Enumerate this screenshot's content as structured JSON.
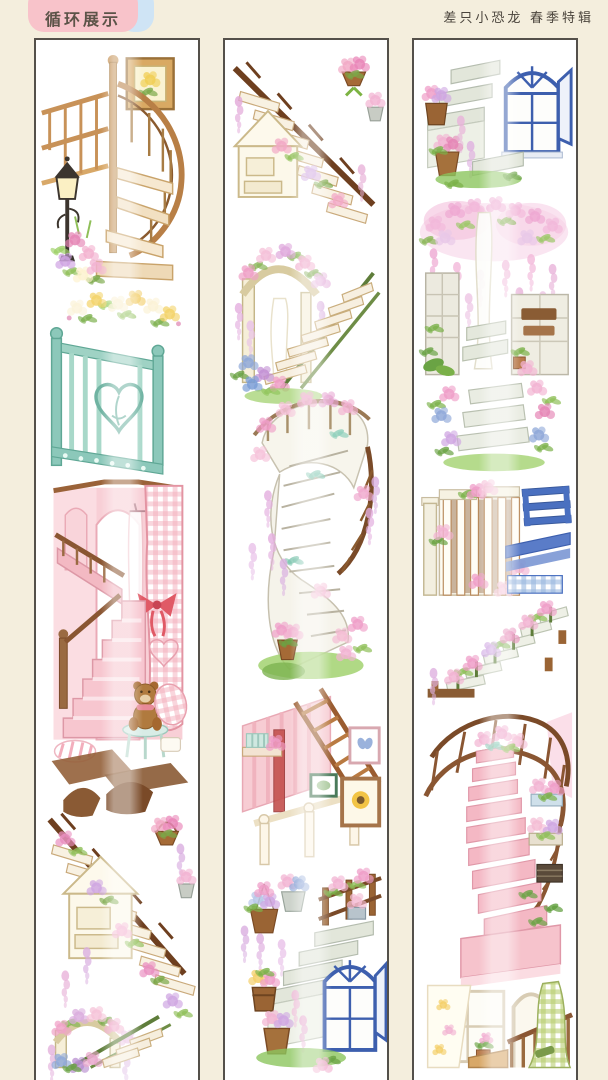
{
  "header": {
    "badge_label": "循环展示",
    "brand_label": "差只小恐龙 春季特辑"
  },
  "colors": {
    "page_background": "#f4eedd",
    "badge_pink": "#f8c3ca",
    "badge_blue": "#cfe4f5",
    "strip_border": "#54504a",
    "strip_background": "#ffffff",
    "text_primary": "#4a443c",
    "accent_wood": "#8a5a34",
    "accent_mint": "#8cc8ba",
    "accent_pink": "#f4b8c4",
    "accent_blue_window": "#3d5fae",
    "accent_green": "#9ccf66",
    "accent_wisteria": "#e3aede"
  },
  "strips": [
    {
      "id": "tape-strip-1",
      "description": "Washi tape strip 1: wooden spiral staircase with street lamp and framed picture; mint iron railing with heart scroll and flower garland; pink interior staircase with gingham curtain and teddy bear; garden staircase with hanging flower baskets; rose arch steps (partial)",
      "vignettes": [
        "wooden-spiral-staircase-with-street-lamp-and-framed-picture",
        "mint-iron-railing-with-heart-scroll-and-flower-garland",
        "pink-interior-staircase-with-gingham-curtain-and-teddy-bear",
        "garden-staircase-with-hanging-flower-baskets",
        "rose-arch-steps-with-green-railing-partial"
      ]
    },
    {
      "id": "tape-strip-2",
      "description": "Washi tape strip 2: garden staircase continued; rose arch steps with green railing; white spiral staircase wrapped in roses and wisteria; pink attic stair with picture frames; stone steps with blue arched window and flower barrels",
      "vignettes": [
        "garden-staircase-with-hanging-flower-baskets-continued",
        "rose-arch-steps-with-green-railing",
        "white-spiral-staircase-wrapped-in-roses-and-wisteria",
        "pink-attic-stair-with-picture-frames",
        "stone-steps-with-blue-arched-window-and-flower-barrels"
      ]
    },
    {
      "id": "tape-strip-3",
      "description": "Washi tape strip 3: stone steps with blue arched window continued; wisteria stone gateway with steps; hydrangea garden steps; white picket gate with blue bench steps; flower lined descending steps; curved pink staircase with iron railing and planters; window with floral curtain and green gingham stair (partial)",
      "vignettes": [
        "stone-steps-with-blue-arched-window-continued",
        "wisteria-stone-gateway-with-steps",
        "hydrangea-garden-steps",
        "white-picket-gate-with-blue-bench-steps",
        "flower-lined-descending-steps",
        "curved-pink-staircase-with-iron-railing-and-planters",
        "window-with-floral-curtain-and-green-gingham-stair-partial"
      ]
    }
  ]
}
